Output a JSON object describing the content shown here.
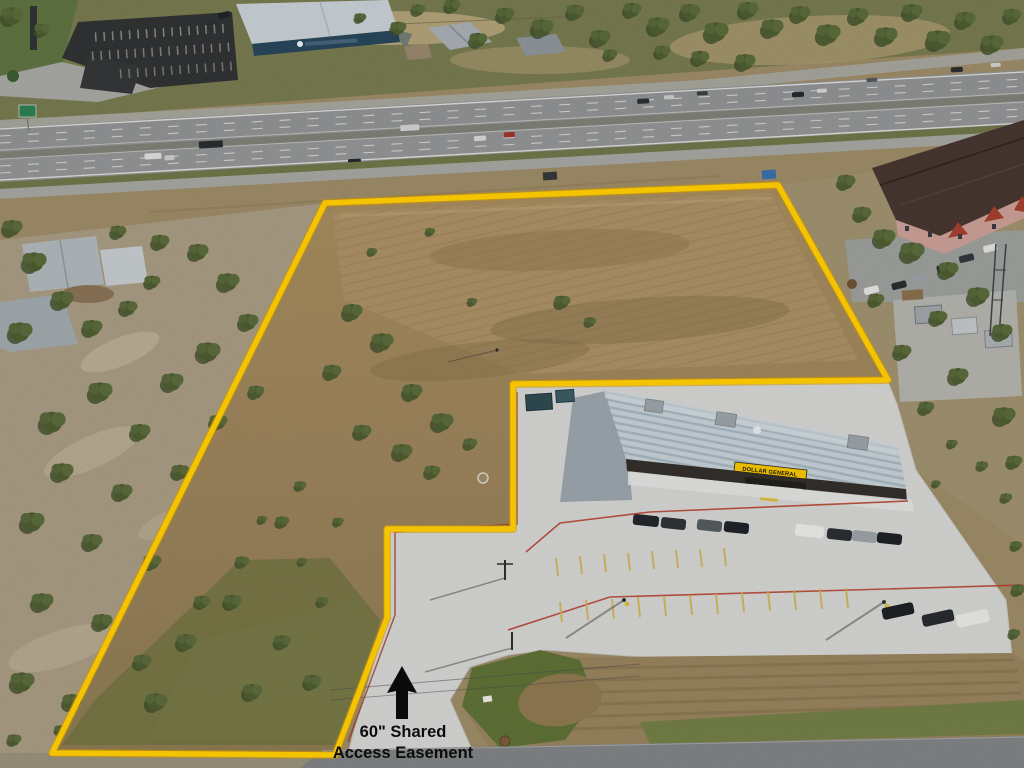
{
  "annotation": {
    "line1": "60\" Shared",
    "line2": "Access Easement",
    "icon": "up-arrow-icon",
    "arrow_color": "#0b0b0b",
    "text_color": "#0d0d0d"
  },
  "store": {
    "sign_text": "DOLLAR GENERAL",
    "sign_bg": "#F2C400",
    "sign_text_color": "#181206"
  },
  "boundary": {
    "color": "#FFCD00"
  },
  "colors": {
    "highway_asphalt": "#8f9193",
    "concrete_lot": "#d3d4d2",
    "parcel_dirt": "#9c8258",
    "parking_stripe_yellow": "#cdb04a",
    "curb_red": "#b23a28",
    "highway_sign_green": "#2e7d4f"
  }
}
